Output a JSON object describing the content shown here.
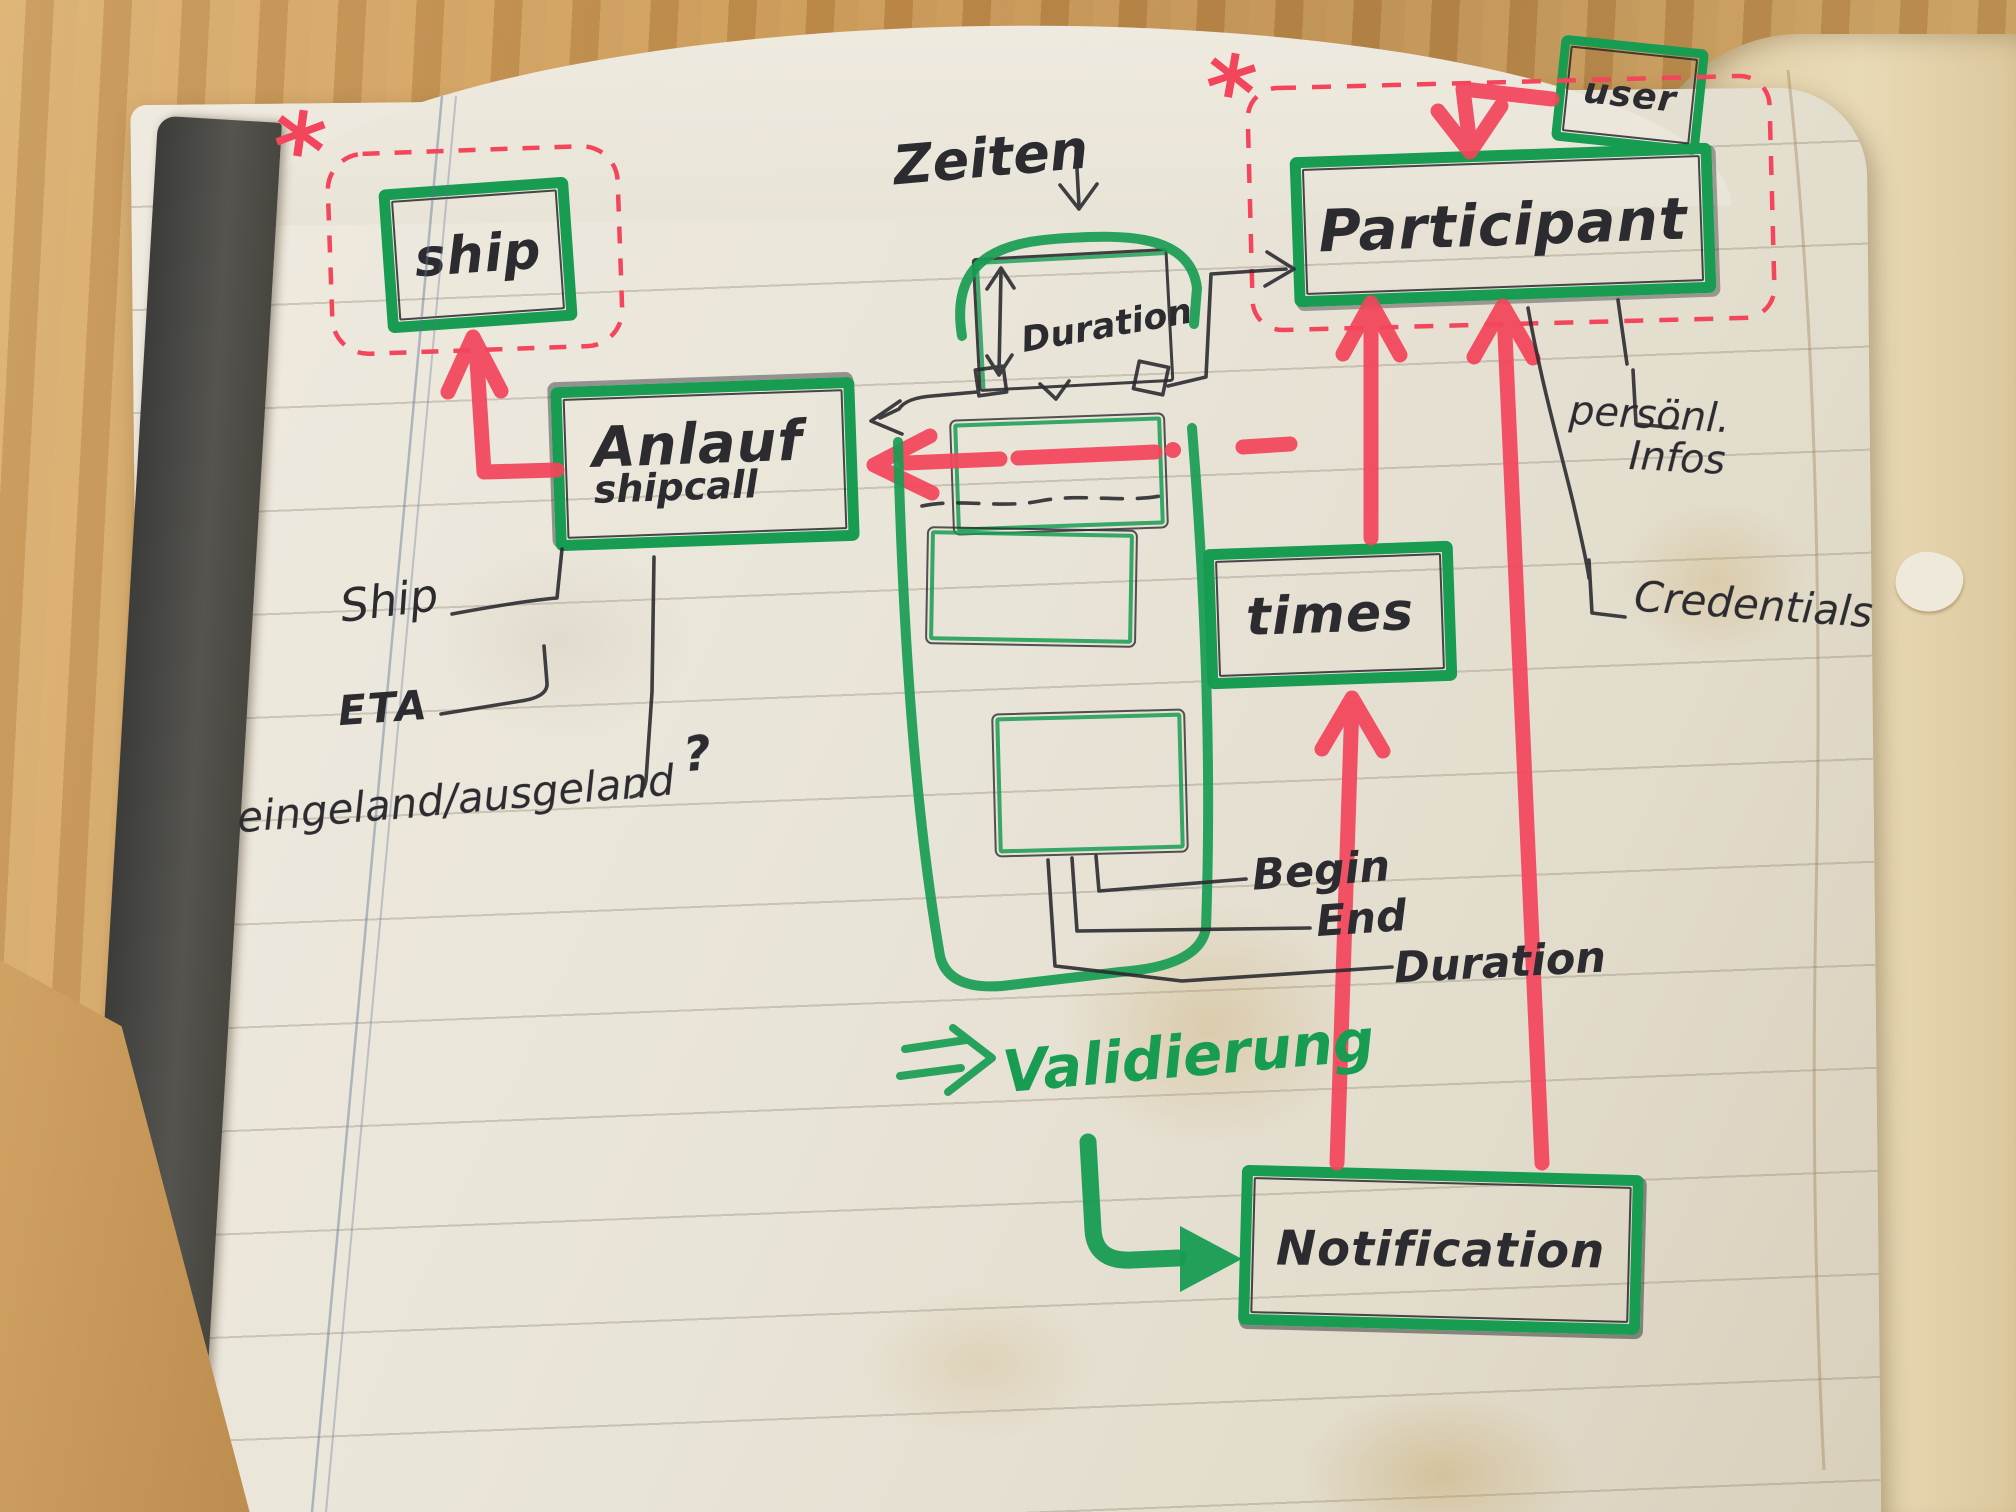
{
  "sketch": {
    "heading": {
      "zeiten": "Zeiten",
      "zeiten_arrow": "↓"
    },
    "nodes": {
      "ship": {
        "label": "ship"
      },
      "anlauf": {
        "label": "Anlauf",
        "sublabel": "shipcall"
      },
      "duration_box": {
        "label": "Duration"
      },
      "participant": {
        "label": "Participant"
      },
      "user": {
        "label": "user"
      },
      "times": {
        "label": "times"
      },
      "notification": {
        "label": "Notification"
      }
    },
    "field_labels": {
      "ship": "Ship",
      "eta": "ETA",
      "in_out": "eingeland/ausgeland",
      "in_out_q": "?",
      "begin": "Begin",
      "end": "End",
      "duration": "Duration",
      "personal_infos_line1": "persönl.",
      "personal_infos_line2": "Infos",
      "credentials": "Credentials"
    },
    "notes": {
      "validation": "Validierung",
      "asterisk_left": "*",
      "asterisk_right": "*"
    },
    "relations": [
      {
        "from": "anlauf",
        "to": "ship",
        "marker": "red-arrow"
      },
      {
        "from": "user",
        "to": "participant",
        "marker": "red-arrow"
      },
      {
        "from": "notification",
        "to": "times",
        "marker": "red-arrow"
      },
      {
        "from": "times",
        "to": "participant",
        "marker": "red-arrow"
      },
      {
        "from": "notification",
        "to": "participant",
        "marker": "red-arrow"
      },
      {
        "from": "zeiten-list",
        "to": "anlauf",
        "marker": "red-dashed-arrow"
      },
      {
        "from": "duration_box",
        "to": "anlauf",
        "marker": "pen-arrow"
      },
      {
        "from": "duration_box",
        "to": "participant",
        "marker": "pen-arrow"
      },
      {
        "from": "validation-note",
        "to": "notification",
        "marker": "green-arrow"
      }
    ],
    "colors": {
      "marker_green": "#179c52",
      "marker_red": "#f3455b",
      "pen_black": "#2b2b30",
      "paper": "#e9e4d8",
      "wood": "#c6924f"
    }
  }
}
